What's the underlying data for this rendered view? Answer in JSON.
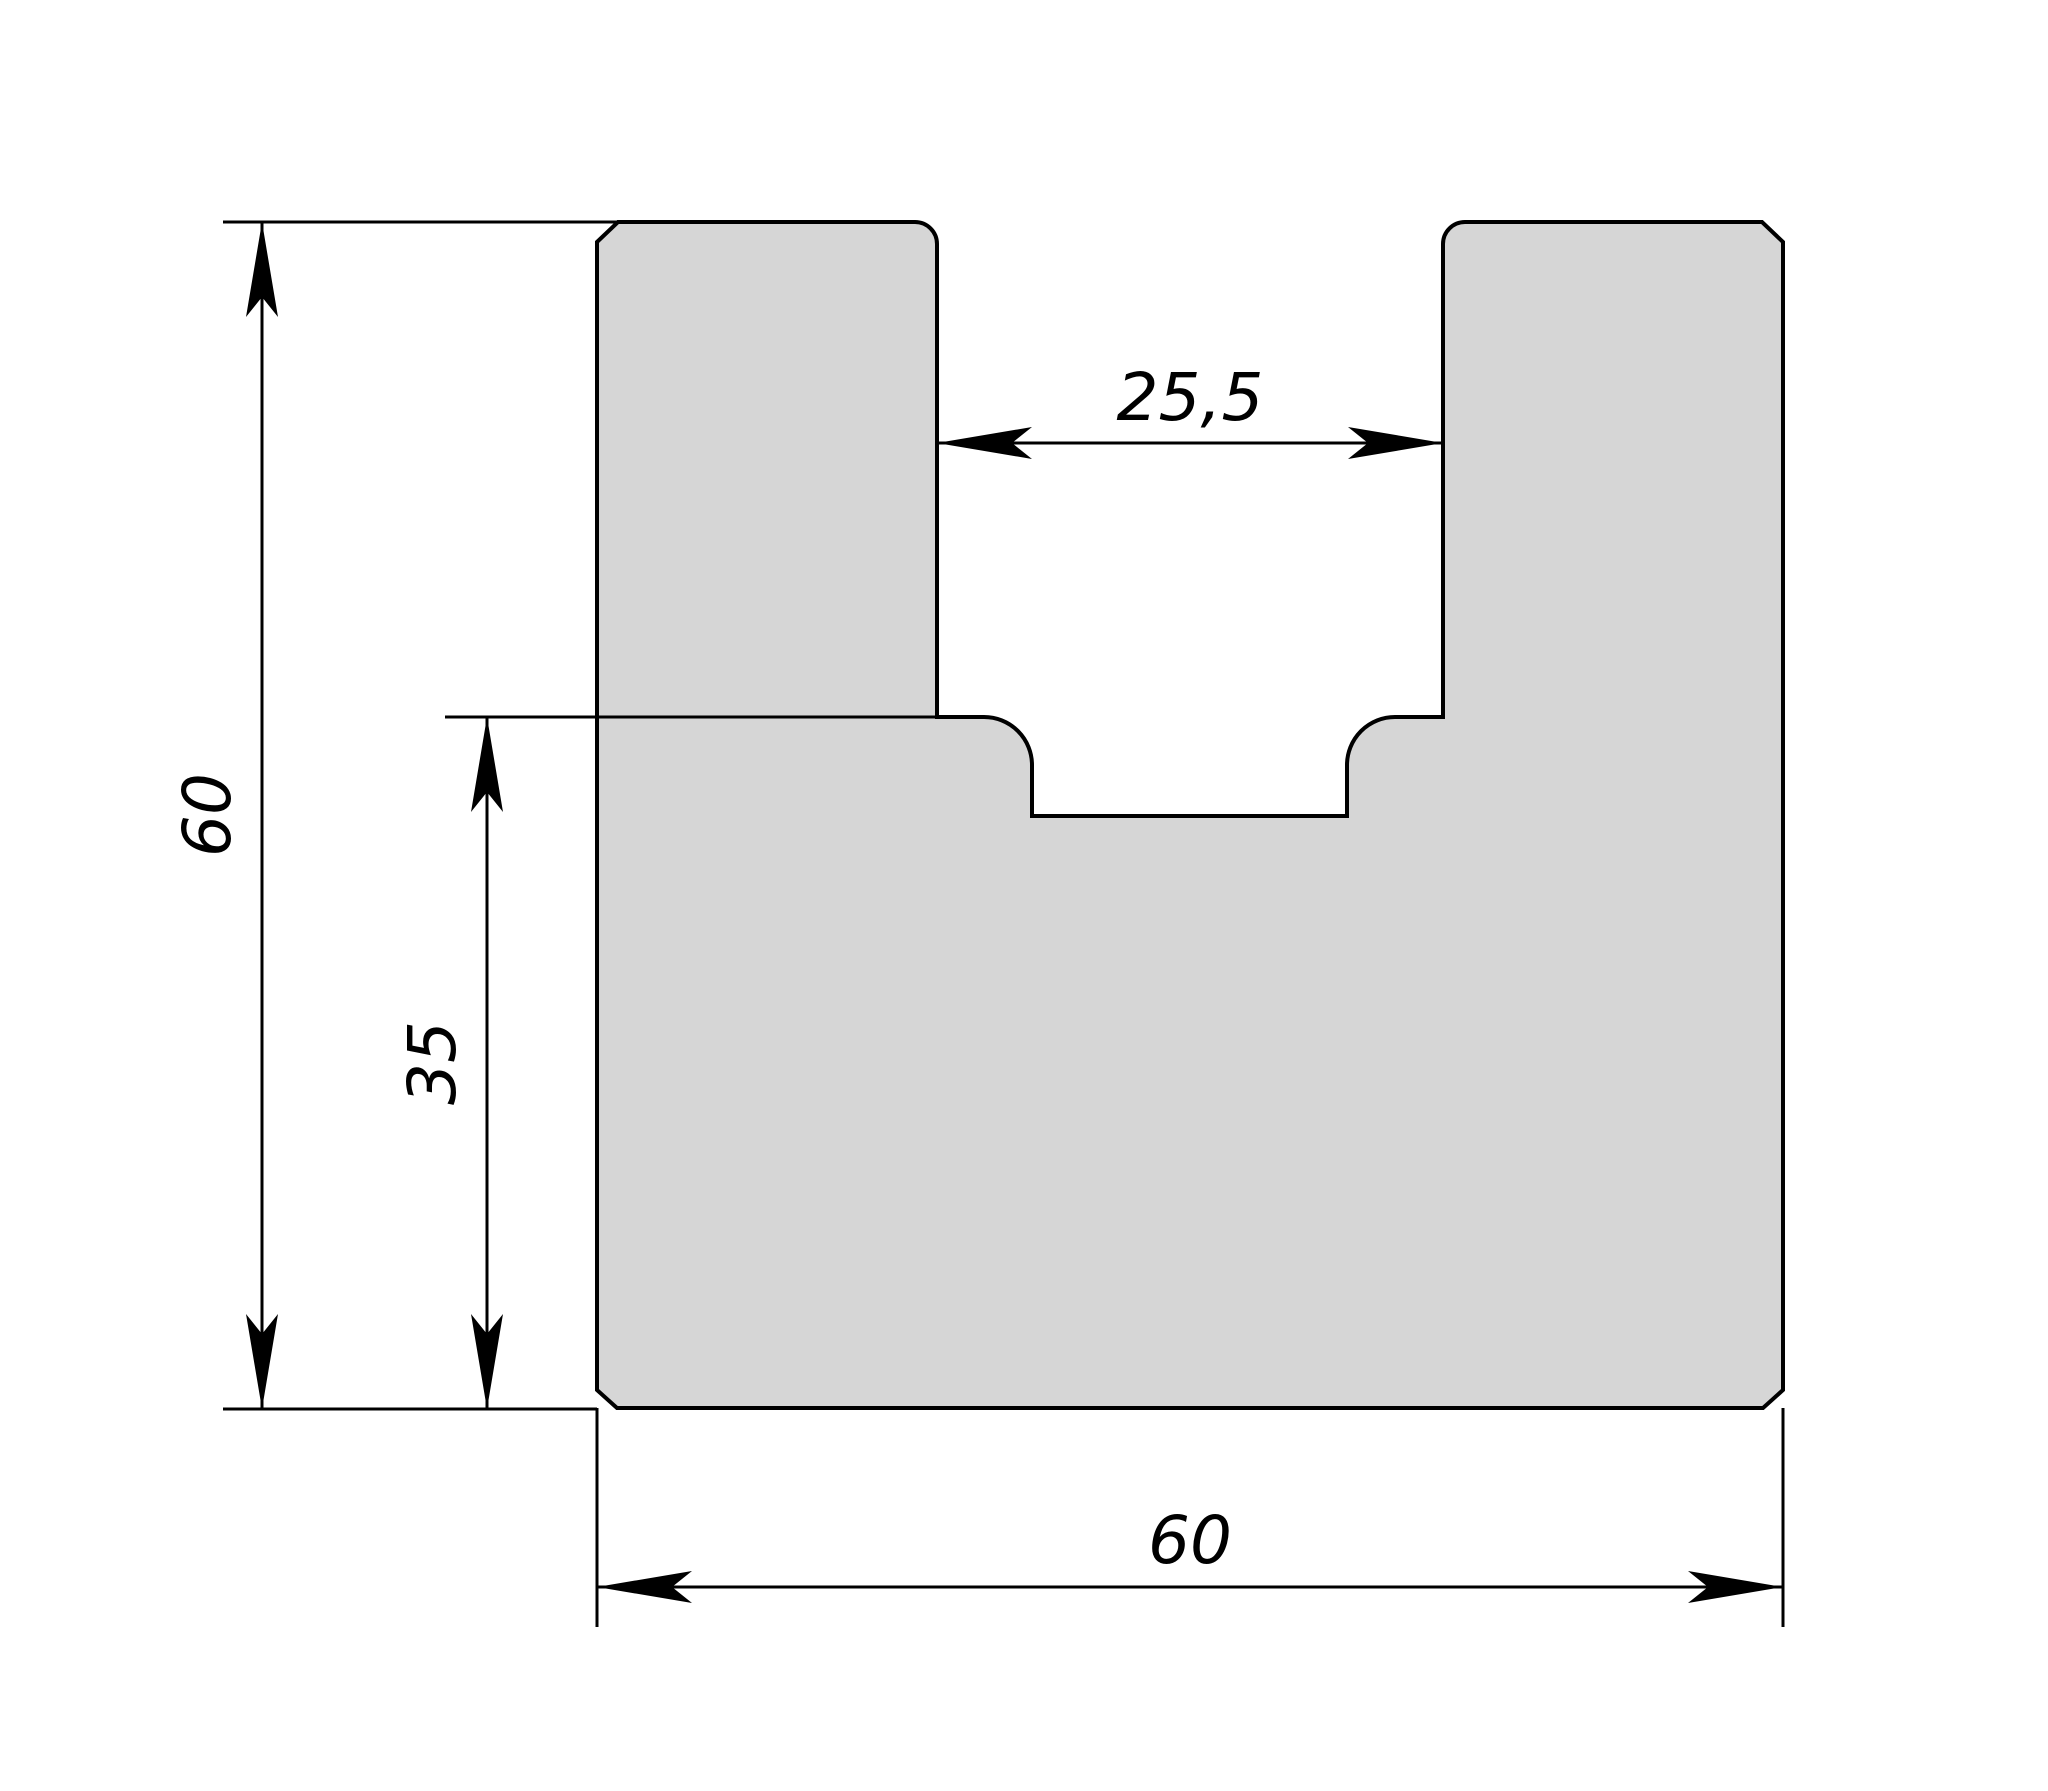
{
  "drawing": {
    "background": "#ffffff",
    "part_fill": "#d6d6d6",
    "line_color": "#000000",
    "type_note": "2D technical drawing of U-shaped slotted block profile",
    "dimensions": {
      "overall_height": {
        "label": "60"
      },
      "step_height": {
        "label": "35"
      },
      "slot_width": {
        "label": "25,5"
      },
      "overall_width": {
        "label": "60"
      }
    }
  }
}
